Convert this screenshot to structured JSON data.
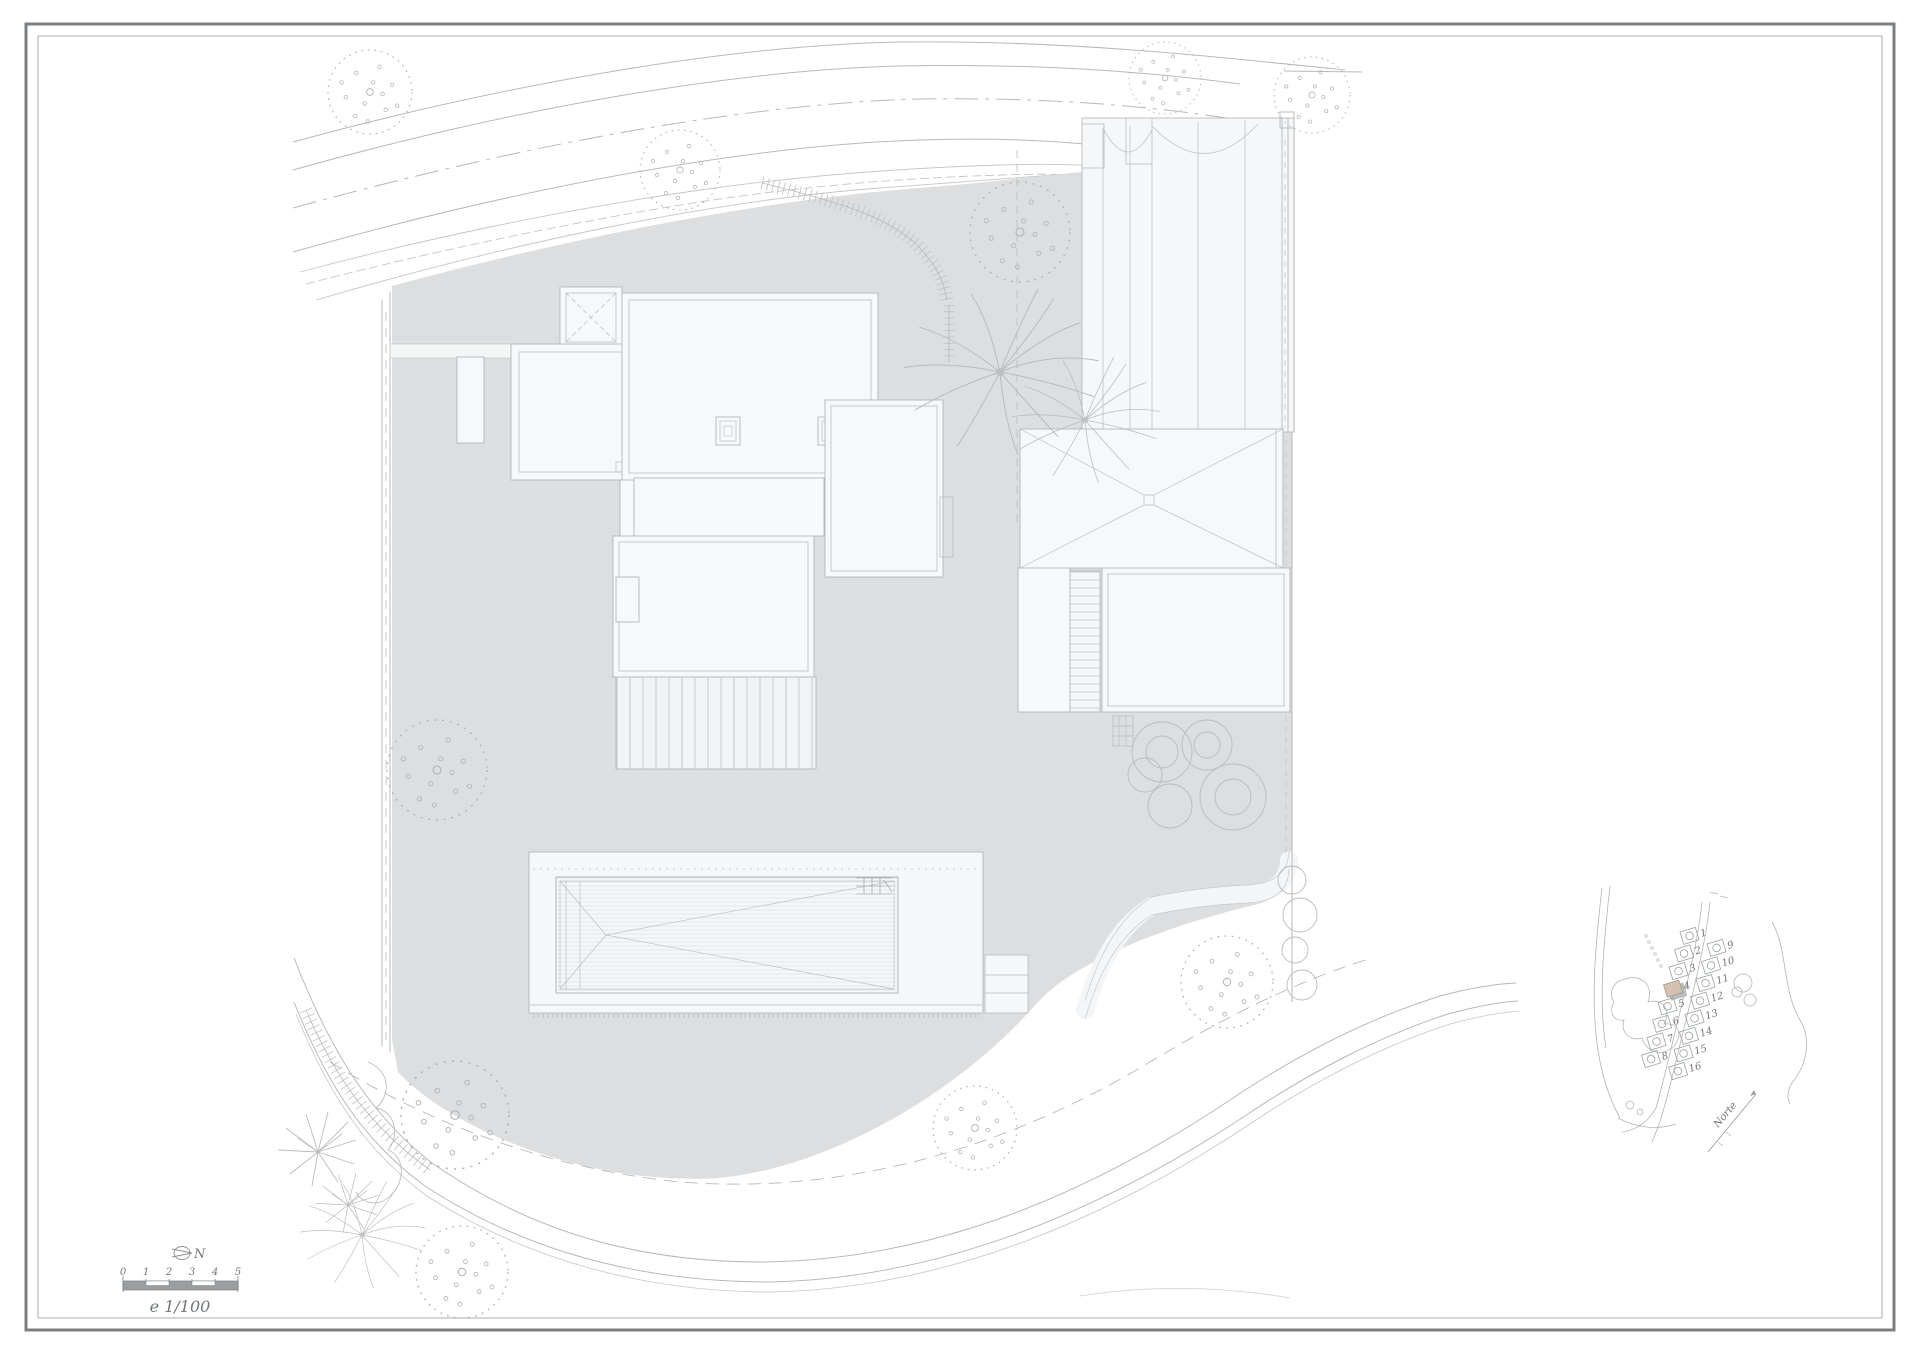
{
  "drawing": {
    "type": "architectural-site-plan",
    "sheet": "roof / site plan with pool, landscaping and location key map"
  },
  "scalebar": {
    "ticks": [
      "0",
      "1",
      "2",
      "3",
      "4",
      "5"
    ],
    "label": "e 1/100"
  },
  "north_symbol": {
    "label": "N"
  },
  "keymap": {
    "plots": [
      "1",
      "2",
      "3",
      "4",
      "5",
      "6",
      "7",
      "8",
      "9",
      "10",
      "11",
      "12",
      "13",
      "14",
      "15",
      "16"
    ],
    "highlighted_plot": "4",
    "north_label": "Norte"
  },
  "colors": {
    "paper": "#ffffff",
    "site_fill": "#dcdee0",
    "roof_fill": "#f7f8f9",
    "line": "#b6b9bb",
    "line_soft": "#cbced0",
    "frame_outer": "#7c7f81",
    "frame_inner": "#abaeb0",
    "highlight": "#d6c1b0",
    "shadow": "#b9bcbd",
    "scalebar_fill": "#9b9ea0",
    "text": "#70767a"
  }
}
